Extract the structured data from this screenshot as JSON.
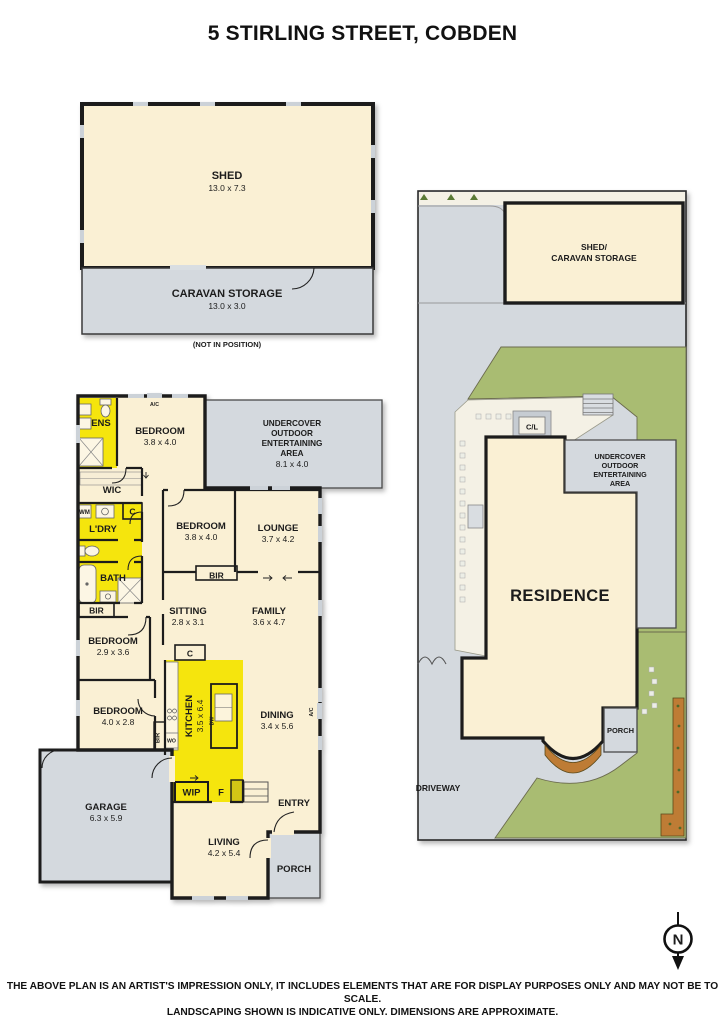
{
  "title": "5 STIRLING STREET, COBDEN",
  "disclaimer": {
    "line1": "THE ABOVE PLAN IS AN ARTIST'S IMPRESSION ONLY, IT INCLUDES ELEMENTS THAT ARE FOR DISPLAY PURPOSES ONLY AND MAY NOT BE TO SCALE.",
    "line2": "LANDSCAPING SHOWN IS INDICATIVE ONLY. DIMENSIONS ARE APPROXIMATE."
  },
  "compass": {
    "north": "N"
  },
  "shed_plan": {
    "shed": {
      "name": "SHED",
      "dims": "13.0 x 7.3"
    },
    "caravan": {
      "name": "CARAVAN STORAGE",
      "dims": "13.0 x 3.0"
    },
    "note": "(NOT IN POSITION)"
  },
  "site_plan": {
    "shed_caravan": {
      "line1": "SHED/",
      "line2": "CARAVAN STORAGE"
    },
    "clothesline": "C/L",
    "uoea": {
      "line1": "UNDERCOVER",
      "line2": "OUTDOOR",
      "line3": "ENTERTAINING",
      "line4": "AREA"
    },
    "residence": "RESIDENCE",
    "porch": "PORCH",
    "driveway": "DRIVEWAY"
  },
  "floor_plan": {
    "ens": "ENS",
    "bedroom1": {
      "name": "BEDROOM",
      "dims": "3.8 x 4.0"
    },
    "uoea": {
      "line1": "UNDERCOVER",
      "line2": "OUTDOOR",
      "line3": "ENTERTAINING",
      "line4": "AREA",
      "dims": "8.1 x 4.0"
    },
    "wic": "WIC",
    "wm": "WM",
    "cupboard1": "C",
    "ldry": "L'DRY",
    "bath": "BATH",
    "bir1": "BIR",
    "bedroom2": {
      "name": "BEDROOM",
      "dims": "3.8 x 4.0"
    },
    "lounge": {
      "name": "LOUNGE",
      "dims": "3.7 x 4.2"
    },
    "bir2": "BIR",
    "sitting": {
      "name": "SITTING",
      "dims": "2.8 x 3.1"
    },
    "family": {
      "name": "FAMILY",
      "dims": "3.6 x 4.7"
    },
    "bedroom3": {
      "name": "BEDROOM",
      "dims": "2.9 x 3.6"
    },
    "cupboard2": "C",
    "kitchen": {
      "name": "KITCHEN",
      "dims": "3.5 x 6.4"
    },
    "dining": {
      "name": "DINING",
      "dims": "3.4 x 5.6"
    },
    "bedroom4": {
      "name": "BEDROOM",
      "dims": "4.0 x 2.8"
    },
    "bir3": "BIR",
    "wo": "WO",
    "dw": "DW",
    "ac1": "A/C",
    "ac2": "A/C",
    "garage": {
      "name": "GARAGE",
      "dims": "6.3 x 5.9"
    },
    "wip": "WIP",
    "fridge": "F",
    "entry": "ENTRY",
    "living": {
      "name": "LIVING",
      "dims": "4.2 x 5.4"
    },
    "porch": "PORCH"
  },
  "colors": {
    "cream": "#FAF0D4",
    "yellow": "#F5E50A",
    "grey": "#D4D9DE",
    "green": "#A9BC72",
    "path": "#F4F1E5",
    "brown": "#BE7B35",
    "wall": "#1D1D1B"
  }
}
